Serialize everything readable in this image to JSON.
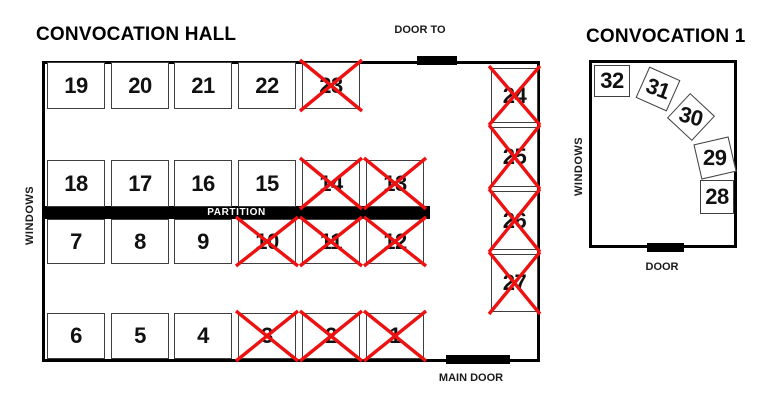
{
  "hall": {
    "title": "CONVOCATION HALL",
    "windows_label": "WINDOWS",
    "partition_label": "PARTITION",
    "top_door_label": "DOOR TO",
    "main_door_label": "MAIN DOOR",
    "rows": [
      {
        "booths": [
          {
            "num": "19",
            "crossed": false
          },
          {
            "num": "20",
            "crossed": false
          },
          {
            "num": "21",
            "crossed": false
          },
          {
            "num": "22",
            "crossed": false
          },
          {
            "num": "23",
            "crossed": true
          }
        ]
      },
      {
        "booths": [
          {
            "num": "18",
            "crossed": false
          },
          {
            "num": "17",
            "crossed": false
          },
          {
            "num": "16",
            "crossed": false
          },
          {
            "num": "15",
            "crossed": false
          },
          {
            "num": "14",
            "crossed": true
          },
          {
            "num": "13",
            "crossed": true
          }
        ]
      },
      {
        "booths": [
          {
            "num": "7",
            "crossed": false
          },
          {
            "num": "8",
            "crossed": false
          },
          {
            "num": "9",
            "crossed": false
          },
          {
            "num": "10",
            "crossed": true
          },
          {
            "num": "11",
            "crossed": true
          },
          {
            "num": "12",
            "crossed": true
          }
        ]
      },
      {
        "booths": [
          {
            "num": "6",
            "crossed": false
          },
          {
            "num": "5",
            "crossed": false
          },
          {
            "num": "4",
            "crossed": false
          },
          {
            "num": "3",
            "crossed": true
          },
          {
            "num": "2",
            "crossed": true
          },
          {
            "num": "1",
            "crossed": true
          }
        ]
      }
    ],
    "right_column": [
      {
        "num": "24",
        "crossed": true
      },
      {
        "num": "25",
        "crossed": true
      },
      {
        "num": "26",
        "crossed": true
      },
      {
        "num": "27",
        "crossed": true
      }
    ]
  },
  "room1": {
    "title": "CONVOCATION 1",
    "windows_label": "WINDOWS",
    "door_label": "DOOR",
    "booths": [
      {
        "num": "32",
        "crossed": false
      },
      {
        "num": "31",
        "crossed": false
      },
      {
        "num": "30",
        "crossed": false
      },
      {
        "num": "29",
        "crossed": false
      },
      {
        "num": "28",
        "crossed": false
      }
    ]
  },
  "colors": {
    "cross": "#ee1111",
    "wall": "#000000",
    "booth_border": "#3f3f3f"
  }
}
